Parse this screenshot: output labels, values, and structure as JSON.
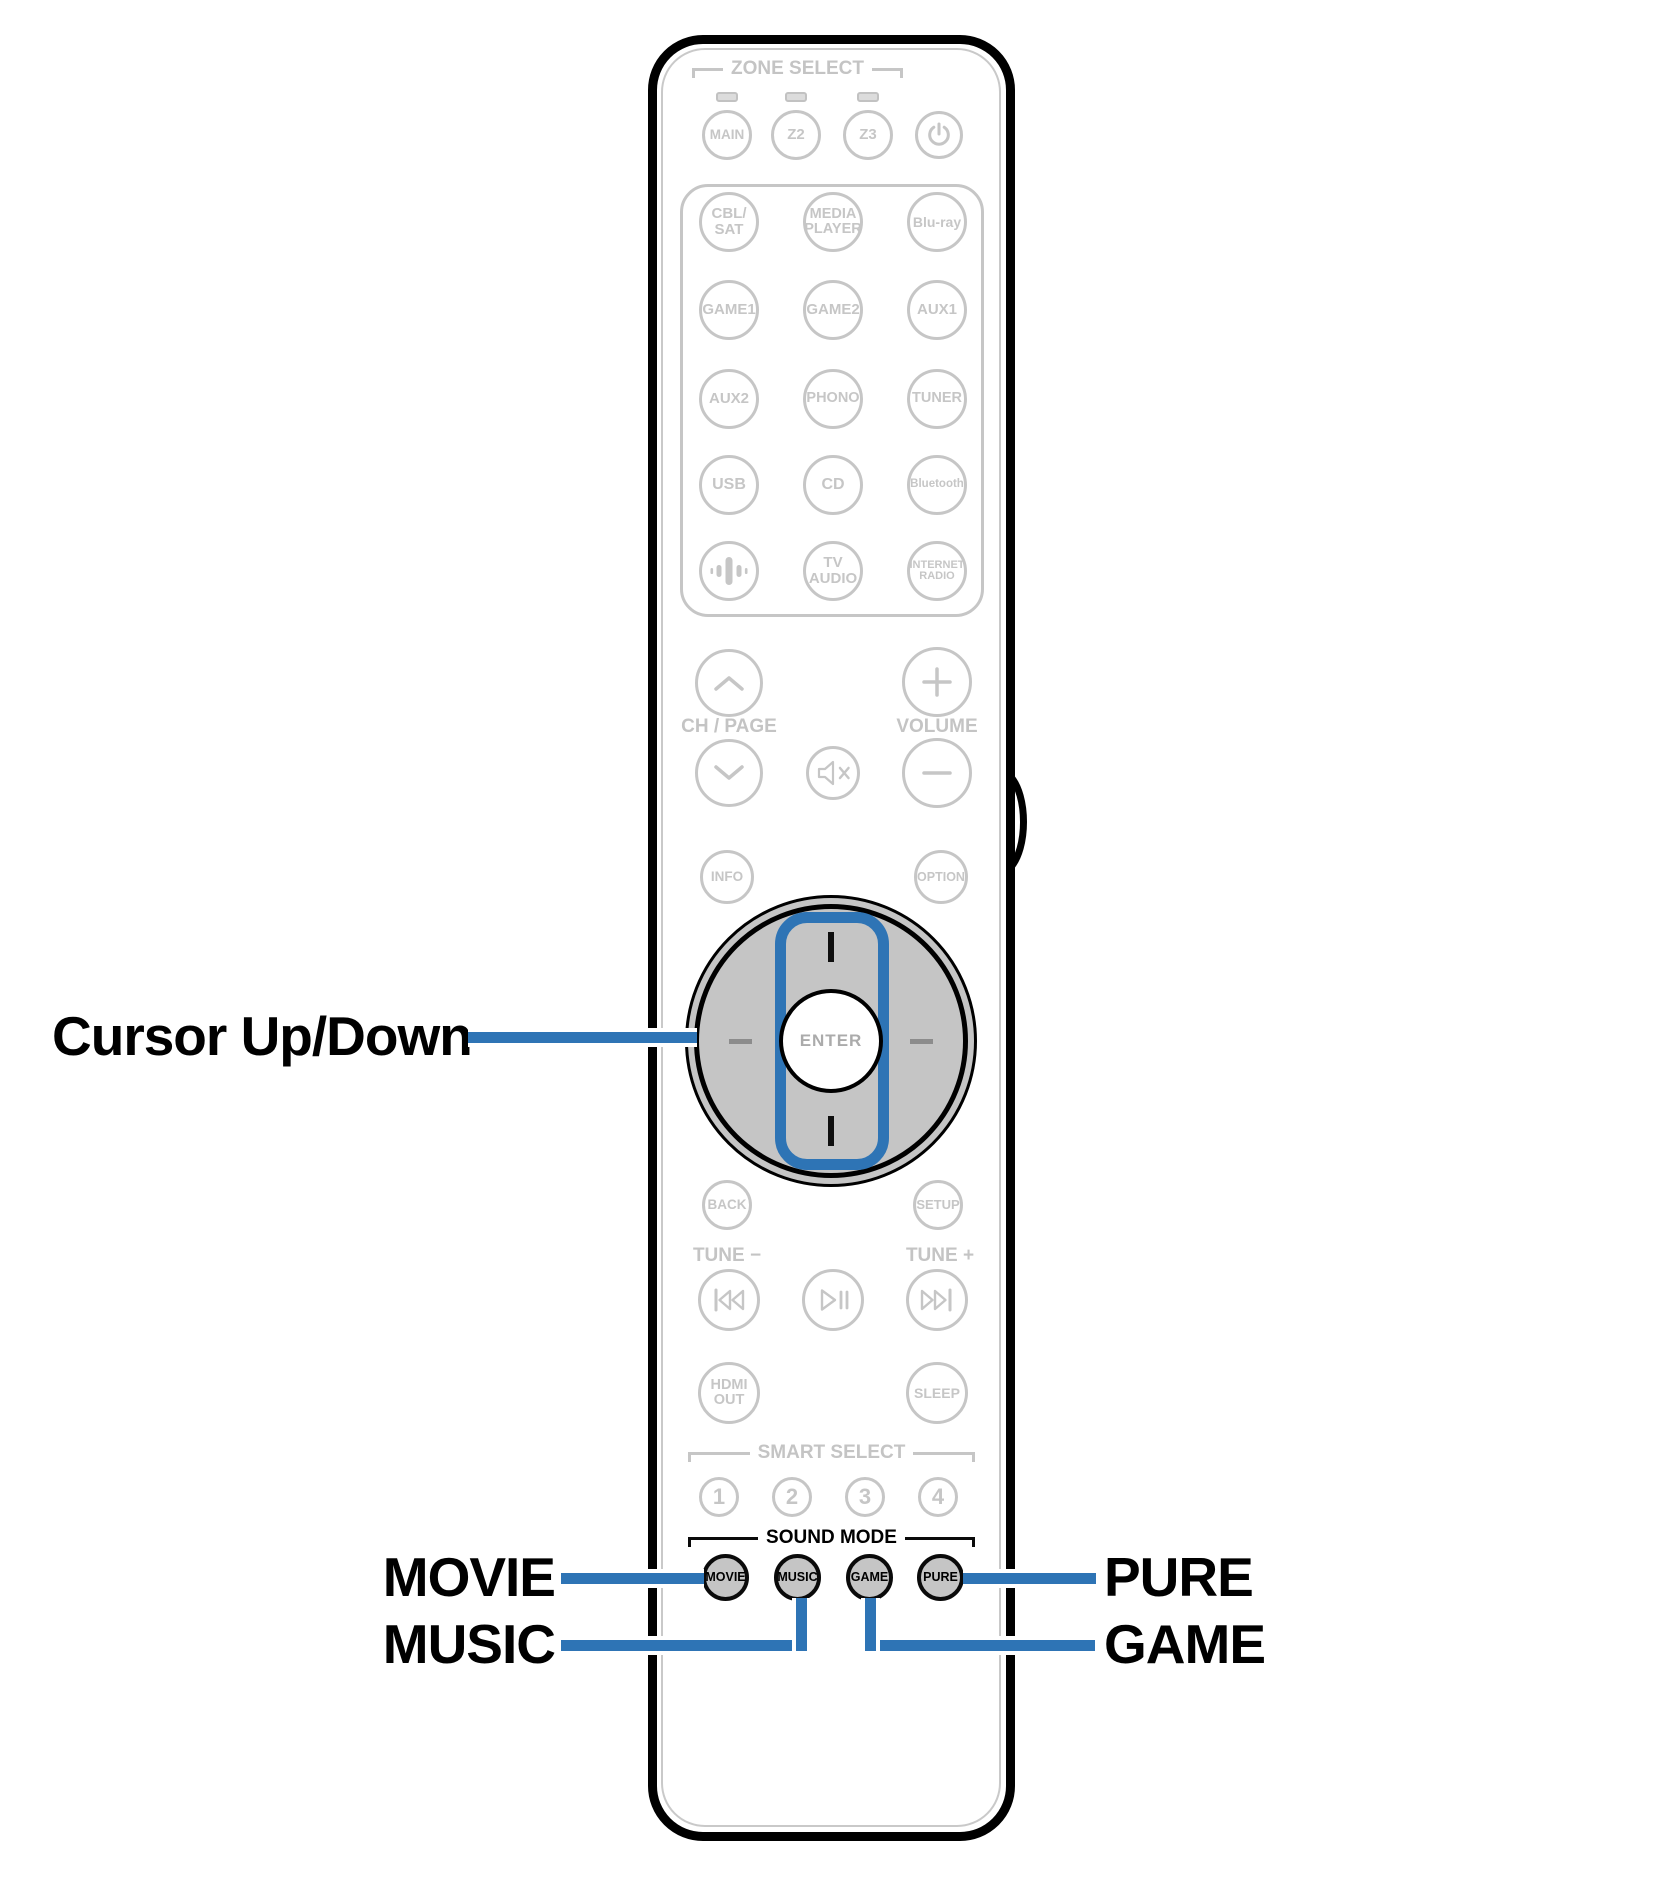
{
  "colors": {
    "accent_blue": "#2E74B5",
    "outline_gray": "#C6C6C6",
    "key_fill_gray": "#C5C5C5"
  },
  "callouts": {
    "cursor_up_down": "Cursor Up/Down",
    "movie": "MOVIE",
    "music": "MUSIC",
    "pure": "PURE",
    "game": "GAME"
  },
  "remote": {
    "zone_select": {
      "label": "ZONE SELECT",
      "main": "MAIN",
      "z2": "Z2",
      "z3": "Z3",
      "power_icon": "power-icon"
    },
    "sources": {
      "cbl_sat": "CBL/\nSAT",
      "media_player": "MEDIA\nPLAYER",
      "bluray": "Blu-ray",
      "game1": "GAME1",
      "game2": "GAME2",
      "aux1": "AUX1",
      "aux2": "AUX2",
      "phono": "PHONO",
      "tuner": "TUNER",
      "usb": "USB",
      "cd": "CD",
      "bluetooth": "Bluetooth",
      "speaker_icon": "speaker-icon",
      "tv_audio": "TV\nAUDIO",
      "internet_radio": "INTERNET\nRADIO"
    },
    "channel_label": "CH / PAGE",
    "volume_label": "VOLUME",
    "info": "INFO",
    "option": "OPTION",
    "enter": "ENTER",
    "back": "BACK",
    "setup": "SETUP",
    "tune_minus": "TUNE −",
    "tune_plus": "TUNE +",
    "hdmi_out": "HDMI\nOUT",
    "sleep": "SLEEP",
    "smart_select": {
      "label": "SMART SELECT",
      "buttons": [
        "1",
        "2",
        "3",
        "4"
      ]
    },
    "sound_mode": {
      "label": "SOUND MODE",
      "movie": "MOVIE",
      "music": "MUSIC",
      "game": "GAME",
      "pure": "PURE"
    }
  }
}
